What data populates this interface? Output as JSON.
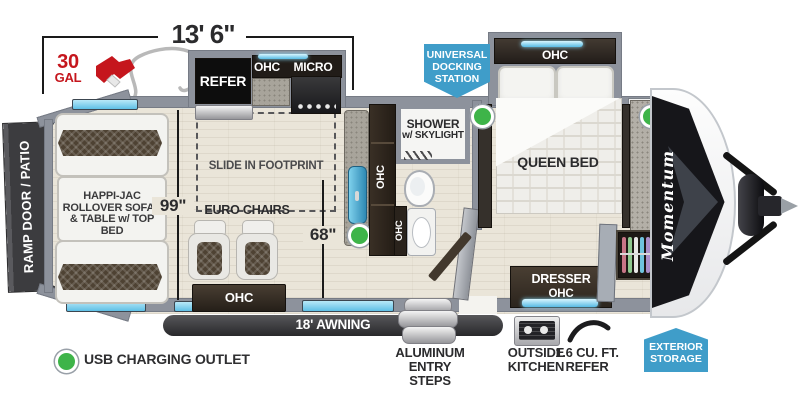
{
  "header": {
    "length_dim": "13' 6\"",
    "fuel_qty": "30",
    "fuel_unit": "GAL"
  },
  "badges": {
    "docking_l1": "UNIVERSAL",
    "docking_l2": "DOCKING",
    "docking_l3": "STATION",
    "storage_l1": "EXTERIOR",
    "storage_l2": "STORAGE"
  },
  "rooms": {
    "ramp_door": "RAMP DOOR / PATIO",
    "happijac_l1": "HAPPI-JAC",
    "happijac_l2": "ROLLOVER SOFAS",
    "happijac_l3": "& TABLE w/ TOP BED",
    "slide_footprint": "SLIDE IN FOOTPRINT",
    "euro_chairs": "EURO CHAIRS",
    "refer": "REFER",
    "micro": "MICRO",
    "ohc": "OHC",
    "shower_l1": "SHOWER",
    "shower_l2": "w/ SKYLIGHT",
    "queen_bed": "QUEEN BED",
    "dresser": "DRESSER",
    "dim_slide": "99\"",
    "dim_aisle": "68\""
  },
  "exterior": {
    "awning": "18' AWNING",
    "steps_l1": "ALUMINUM",
    "steps_l2": "ENTRY STEPS",
    "okitchen_l1": "OUTSIDE",
    "okitchen_l2": "KITCHEN",
    "orefer_l1": "1.6 CU. FT.",
    "orefer_l2": "REFER",
    "brand": "Momentum"
  },
  "legend": {
    "usb": "USB CHARGING OUTLET"
  },
  "colors": {
    "wall": "#8d929c",
    "cabinet": "#2c2520",
    "badge_blue": "#3f9dc9",
    "window_blue": "#5fc0e6",
    "fuel_red": "#c5161d",
    "usb_green": "#3eb449",
    "awning_dark": "#3b3b3d"
  }
}
